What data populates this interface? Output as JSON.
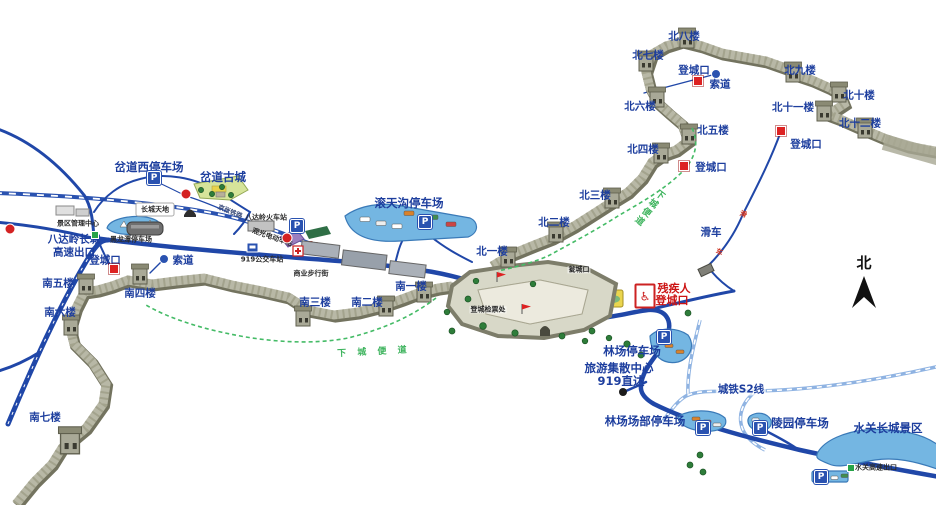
{
  "compass": {
    "label": "北"
  },
  "towers": {
    "north": [
      "北一楼",
      "北二楼",
      "北三楼",
      "北四楼",
      "北五楼",
      "北六楼",
      "北七楼",
      "北八楼",
      "北九楼",
      "北十楼",
      "北十一楼",
      "北十二楼"
    ],
    "south": [
      "南一楼",
      "南二楼",
      "南三楼",
      "南四楼",
      "南五楼",
      "南六楼",
      "南七楼"
    ]
  },
  "markers": {
    "entrance": "登城口",
    "disabled_line1": "残疾人",
    "disabled_line2": "登城口",
    "ticket_office": "登城检票处",
    "weng_gate": "瓮城口"
  },
  "transport": {
    "cableway": "索道",
    "slide": "滑车",
    "slide_route": [
      "滑",
      "车"
    ],
    "railway": "京张铁路",
    "s2": "城铁S2线",
    "train_station": "八达岭火车站",
    "bus_station": "919公交车站",
    "sightseeing": "观光电动车站",
    "direct_line1": "旅游集散中心",
    "direct_line2": "919直达"
  },
  "parking": {
    "p": "P",
    "chadao_west": "岔道西停车场",
    "heilongtan": "黑龙潭停车场",
    "guntiangou": "滚天沟停车场",
    "linchang": "林场停车场",
    "linchang_hq": "林场场部停车场",
    "lingyuan": "陵园停车场"
  },
  "places": {
    "chadao_town": "岔道古城",
    "wall_world": "长城天地",
    "admin": "景区管理中心",
    "expwy_line1": "八达岭长城",
    "expwy_line2": "高速出口",
    "street": "商业步行街",
    "shuiguan": "水关长城景区",
    "shuiguan_exit": "水关高速出口"
  },
  "paths": {
    "descent_north": "下城便道",
    "descent_south": "下 城 便 道"
  },
  "icons": {
    "wheelchair": "♿"
  }
}
